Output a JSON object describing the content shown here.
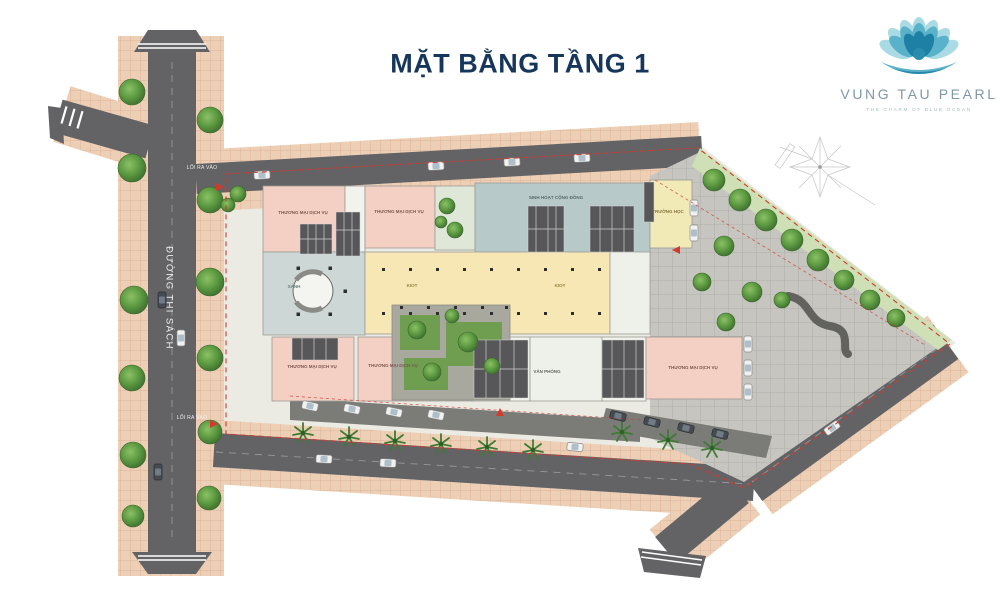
{
  "title": "MẶT BẰNG TẦNG 1",
  "logo": {
    "name": "VUNG TAU PEARL",
    "tagline": "THE CHARM OF BLUE OCEAN"
  },
  "roads": {
    "street_name": "ĐƯỜNG THI SÁCH",
    "entrance_top": "LỐI RA VÀO",
    "entrance_bottom": "LỐI RA VÀO"
  },
  "plan": {
    "block_labels": {
      "commercial": "THƯƠNG MẠI DỊCH VỤ",
      "lobby": "SẢNH",
      "community": "SINH HOẠT CỘNG ĐỒNG",
      "school": "TRƯỜNG HỌC",
      "kiosk": "KIOT",
      "office": "VĂN PHÒNG"
    }
  },
  "colors": {
    "title_navy": "#17365C",
    "logo_teal": "#2F93B8",
    "asphalt": "#636365",
    "sidewalk_pink": "#EDCFB6",
    "commercial_pink": "#F4CFC4",
    "lobby_blue": "#B7C9C9",
    "kiosk_yellow": "#F6E7B4",
    "school_yellow": "#F1E9B6",
    "tree_green": "#55903C",
    "boundary_red": "#D23A2E"
  }
}
